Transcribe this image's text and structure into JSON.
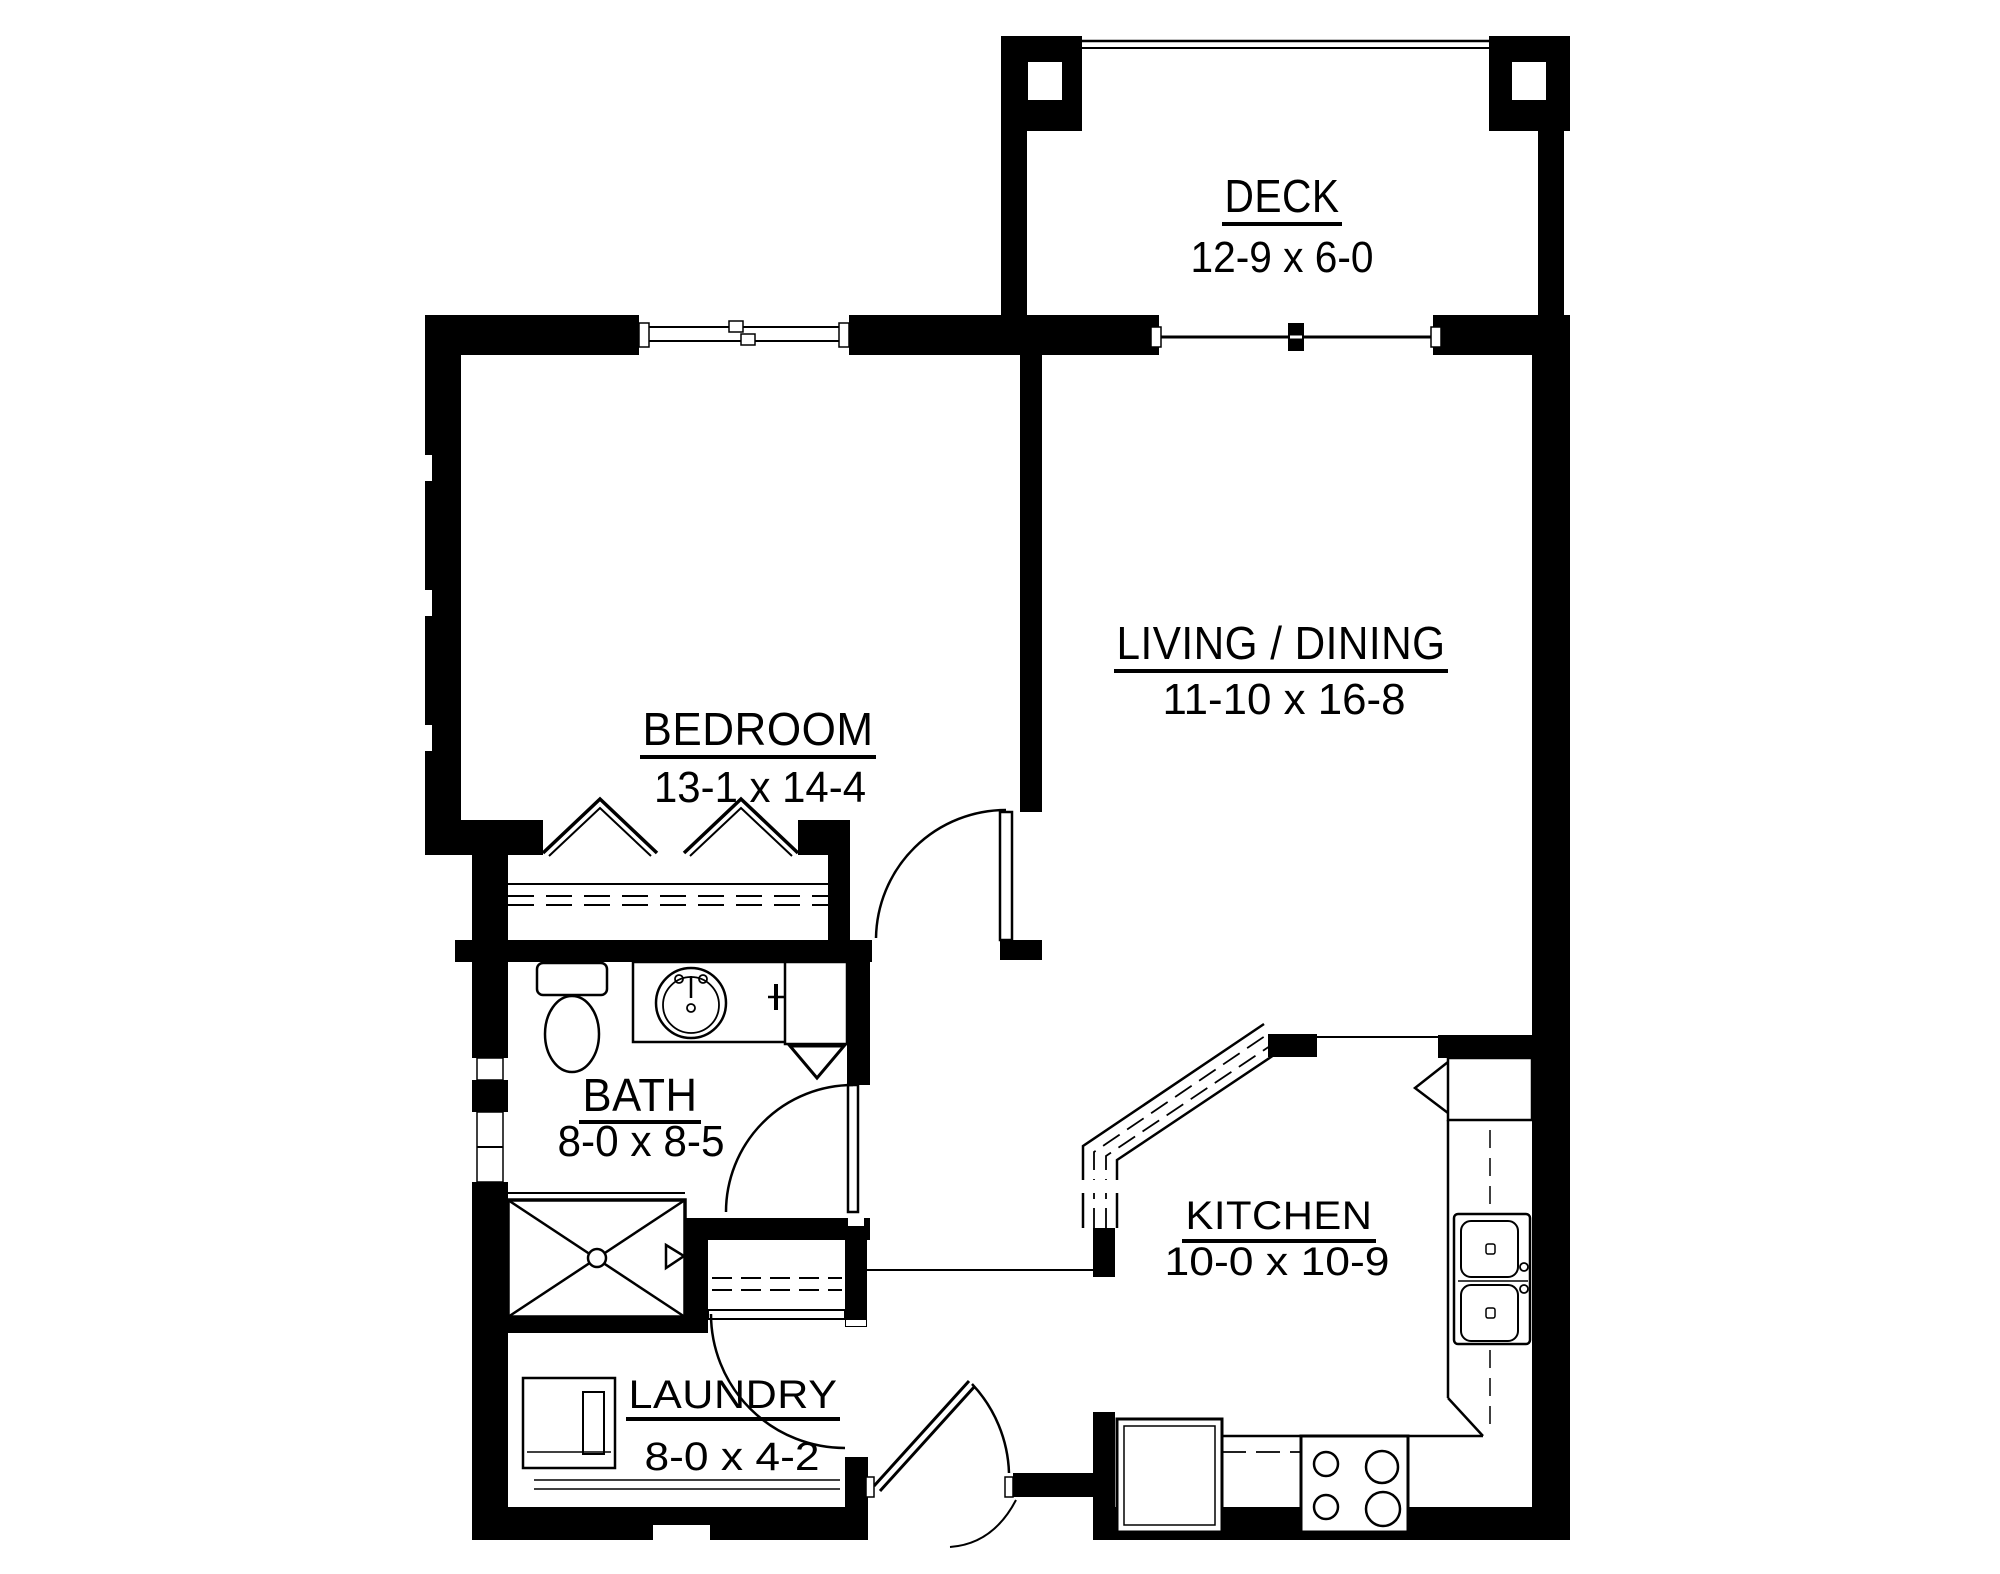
{
  "drawing_type": "apartment-floor-plan",
  "rooms": {
    "deck": {
      "label": "DECK",
      "dims": "12-9 x 6-0"
    },
    "bedroom": {
      "label": "BEDROOM",
      "dims": "13-1 x 14-4"
    },
    "living_dining": {
      "label": "LIVING / DINING",
      "dims": "11-10 x 16-8"
    },
    "bath": {
      "label": "BATH",
      "dims": "8-0 x 8-5"
    },
    "kitchen": {
      "label": "KITCHEN",
      "dims": "10-0 x 10-9"
    },
    "laundry": {
      "label": "LAUNDRY",
      "dims": "8-0 x 4-2"
    }
  },
  "colors": {
    "wall": "#000000",
    "background": "#ffffff",
    "line": "#000000"
  },
  "fixtures": [
    "toilet",
    "round-bathroom-sink",
    "vanity-counter",
    "bath-cabinet",
    "shutoff-valve",
    "shower-with-x",
    "linen-closet-shelves",
    "bedroom-closet-shelf",
    "bifold-closet-doors",
    "washer-dryer",
    "bay-window-counter",
    "kitchen-double-sink",
    "kitchen-counters",
    "corner-cabinet",
    "stove-four-burners",
    "refrigerator",
    "deck-posts",
    "deck-railing",
    "sliding-patio-door",
    "double-hung-window",
    "swing-doors"
  ]
}
